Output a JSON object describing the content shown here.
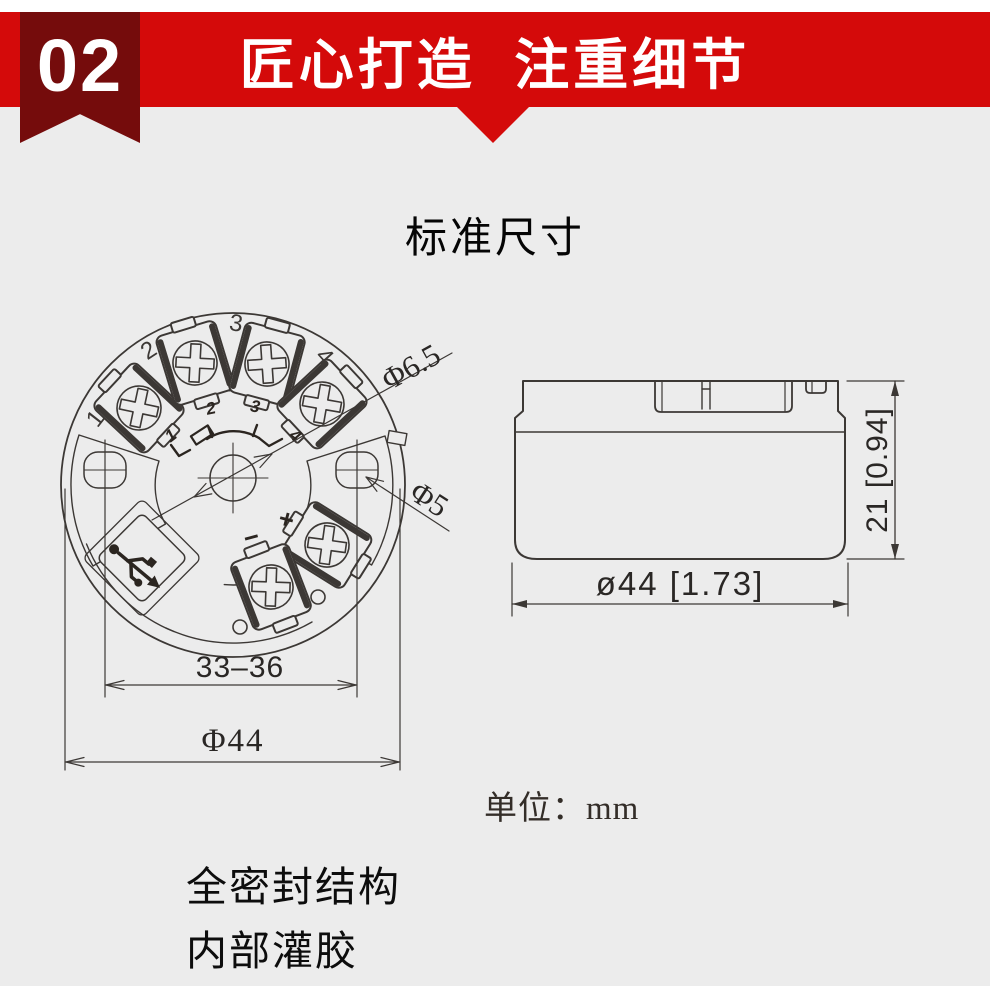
{
  "header": {
    "badge": "02",
    "title": "匠心打造  注重细节",
    "banner_color": "#d40a0a",
    "ribbon_color": "#750c0c"
  },
  "section_title": "标准尺寸",
  "top_view": {
    "outer_terminal_labels": [
      "1",
      "2",
      "3",
      "4"
    ],
    "inner_terminal_labels": [
      "1",
      "2",
      "3",
      "4"
    ],
    "polarity_plus": "+",
    "polarity_minus": "−",
    "dim_center_hole": "Φ6.5",
    "dim_side_hole": "Φ5",
    "dim_mount_span": "33–36",
    "dim_outer_diameter": "Φ44"
  },
  "side_view": {
    "dim_height": "21 [0.94]",
    "dim_width": "ø44 [1.73]"
  },
  "unit_note": "单位：mm",
  "features": [
    "全密封结构",
    "内部灌胶"
  ],
  "colors": {
    "background": "#ececec",
    "line": "#3c3835"
  }
}
